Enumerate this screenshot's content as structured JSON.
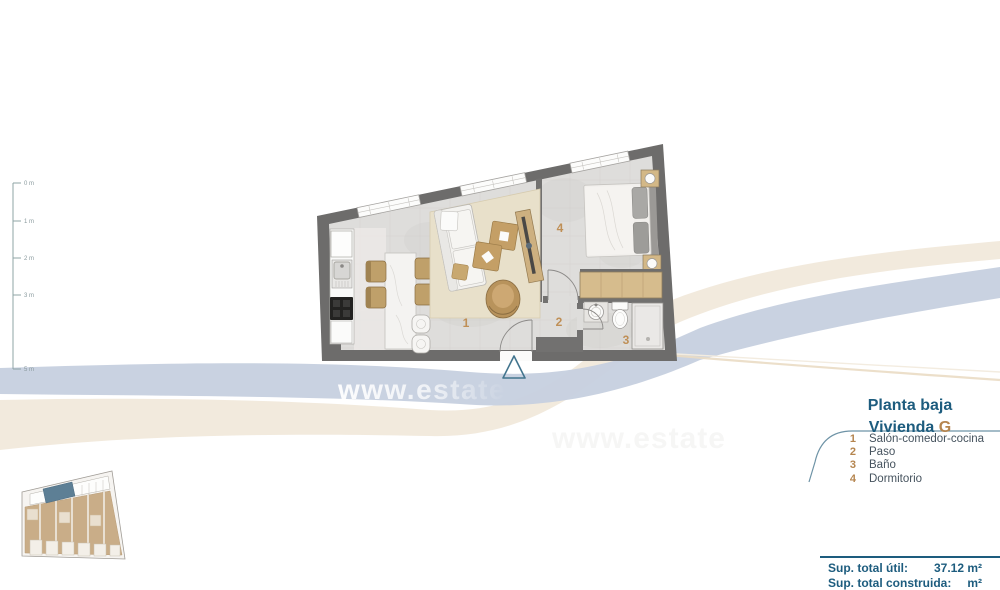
{
  "plan": {
    "title_line1": "Planta baja",
    "title_line2_label": "Vivienda",
    "title_line2_letter": "G",
    "legend": [
      {
        "num": "1",
        "label": "Salón-comedor-cocina"
      },
      {
        "num": "2",
        "label": "Paso"
      },
      {
        "num": "3",
        "label": "Baño"
      },
      {
        "num": "4",
        "label": "Dormitorio"
      }
    ],
    "room_numbers": {
      "living": "1",
      "hall": "2",
      "bath": "3",
      "bedroom": "4"
    },
    "summary": {
      "label": "Sup. total útil:",
      "value": "37.12 m²"
    },
    "summary_secondary": {
      "label": "Sup. total construida:",
      "value": "m²"
    }
  },
  "ruler": {
    "labels": [
      "0 m",
      "1 m",
      "2 m",
      "3 m",
      "5 m"
    ]
  },
  "watermark": {
    "text": "www.estate",
    "ghost_text": "www.estate"
  },
  "colors": {
    "heading_blue": "#1d5c7e",
    "accent_tan": "#b5854f",
    "wall_gray": "#6d6c6b",
    "swoosh_blue": "#c6d0df",
    "swoosh_cream": "#f0e6d7",
    "highlight_unit_blue": "#5d7f95",
    "entrance_marker_teal": "#43758e"
  }
}
